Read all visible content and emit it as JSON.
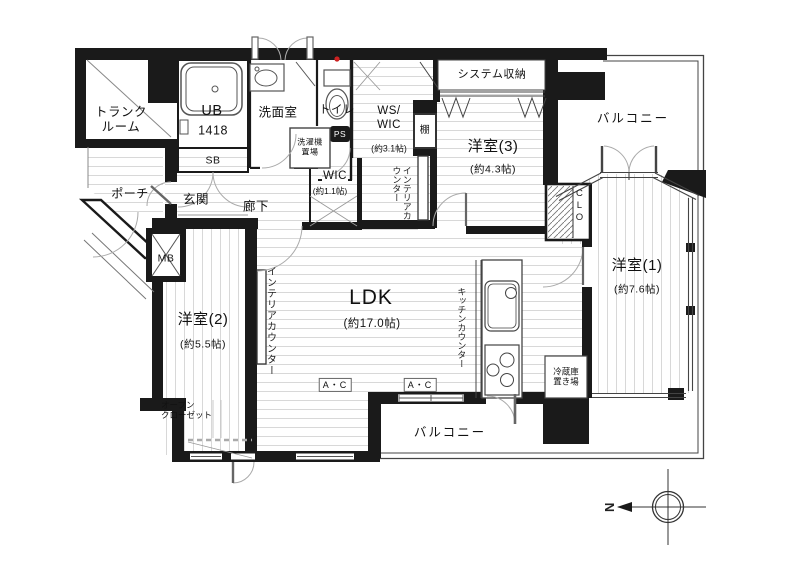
{
  "plan": {
    "rooms": {
      "ldk": {
        "name": "LDK",
        "size": "(約17.0帖)"
      },
      "room1": {
        "name": "洋室(1)",
        "size": "(約7.6帖)"
      },
      "room2": {
        "name": "洋室(2)",
        "size": "(約5.5帖)"
      },
      "room3": {
        "name": "洋室(3)",
        "size": "(約4.3帖)"
      },
      "ws_wic": {
        "name": "WS/\nWIC",
        "size": "(約3.1帖)"
      },
      "wic": {
        "name": "WIC",
        "size": "(約1.1帖)"
      },
      "trunk_room": {
        "name": "トランク\nルーム"
      },
      "unit_bath": {
        "name": "UB",
        "size": "1418"
      },
      "washroom": {
        "name": "洗面室"
      },
      "toilet": {
        "name": "トイレ"
      },
      "entrance": {
        "name": "玄関"
      },
      "hallway": {
        "name": "廊下"
      },
      "porch": {
        "name": "ポーチ"
      }
    },
    "storage": {
      "system_storage": {
        "name": "システム収納"
      },
      "open_closet": {
        "name": "オープン\nクローゼット"
      },
      "closet_clo": {
        "name": "CLO"
      },
      "shelf": {
        "name": "棚"
      },
      "shoe_box": {
        "name": "SB"
      }
    },
    "balconies": {
      "top": {
        "name": "バルコニー"
      },
      "bottom": {
        "name": "バルコニー"
      }
    },
    "equipment": {
      "washer_space": {
        "name": "洗濯機\n置場"
      },
      "refrigerator_space": {
        "name": "冷蔵庫\n置き場"
      },
      "meter_box": {
        "name": "MB"
      },
      "pipe_space_upper": {
        "name": "PS"
      },
      "pipe_space_kitchen": {
        "name": "PS"
      },
      "air_conditioner_1": {
        "name": "A・C"
      },
      "air_conditioner_2": {
        "name": "A・C"
      }
    },
    "counters": {
      "interior_counter_hall": {
        "name": "インテリアカウンター"
      },
      "interior_counter_ldk": {
        "name": "インテリアカウンター"
      },
      "kitchen_counter": {
        "name": "キッチンカウンター"
      }
    },
    "compass": {
      "north": "N"
    },
    "colors": {
      "wall": "#1a1a1a",
      "floor_line": "#d4d4d4",
      "alarm_dot": "#cc2222"
    }
  }
}
